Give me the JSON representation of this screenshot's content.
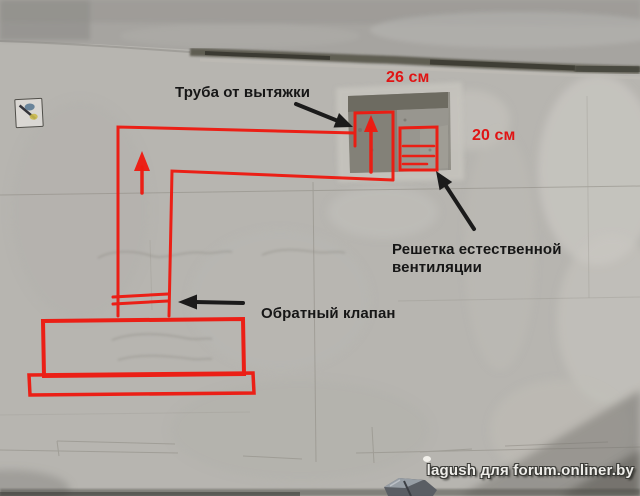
{
  "colors": {
    "annotation_red": "#ee1a10",
    "dimension_red": "#e01414",
    "label_black": "#1b1b1b",
    "watermark_white": "#efeeea"
  },
  "annotations": {
    "pipe_label": "Труба от вытяжки",
    "top_dimension": "26 см",
    "side_dimension": "20 см",
    "grille_label_line1": "Решетка естественной",
    "grille_label_line2": "вентиляции",
    "valve_label": "Обратный клапан"
  },
  "watermark": {
    "text": "lagush для forum.onliner.by"
  },
  "diagram_elements": {
    "duct": "exhaust-duct-outline",
    "pipe_stub": "exhaust-pipe-at-vent-hole",
    "grille": "natural-ventilation-grille",
    "valve": "check-valve-symbol",
    "hood": "cooker-hood-outline",
    "flow": "air-flow-up-arrows"
  }
}
